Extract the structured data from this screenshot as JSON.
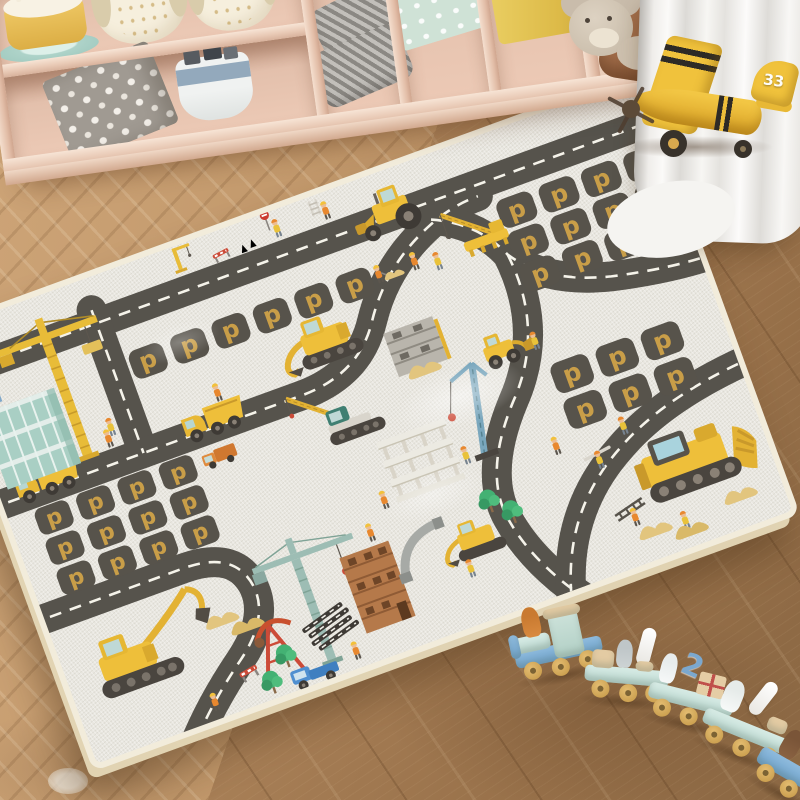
{
  "scene": {
    "name": "kids-playroom-with-construction-play-mat"
  },
  "colors": {
    "mat_background": "#e9e7e0",
    "mat_edge": "#f2ecdb",
    "road": "#56534c",
    "road_dash": "#f5f3ea",
    "parking_square": "#57534b",
    "parking_letter": "#c99e48",
    "machine_yellow": "#eebf3a",
    "shelf_wood": "#eed3c2",
    "floor_wood": "#b98f62",
    "curtain_white": "#f3f2ef",
    "train_mint": "#cfe6df",
    "train_blue": "#7fb0d6",
    "train_wheel": "#d9ae5c",
    "plane_yellow": "#f0c23c",
    "crane_teal": "#9dbdb4",
    "crane_blue": "#7aa7bd",
    "brick_brown": "#b5794a",
    "tree_green": "#43b173",
    "sand_tan": "#e2c57e"
  },
  "shelf": {
    "items": [
      "birthday-cake-toy",
      "owl-plush-large",
      "owl-plush-small",
      "polka-dot-storage-box",
      "toy-basket-with-blocks",
      "chevron-cushions",
      "pink-storage-bin",
      "white-storage-box",
      "mint-polka-bin",
      "yellow-storage-bin",
      "teddy-bear",
      "brown-cushion"
    ]
  },
  "plane": {
    "name": "yellow-toy-airplane",
    "tail_number": "33"
  },
  "mat": {
    "name": "construction-road-play-mat",
    "parking_letter": "p",
    "features": [
      "roads-with-dashed-lines",
      "parking-spots",
      "backhoe-loader",
      "mobile-crane",
      "excavator",
      "dump-trucks",
      "yellow-tower-crane",
      "glass-building",
      "crawler-crane",
      "scaffold-building",
      "wheel-loader",
      "blue-tower-crane",
      "building-frame",
      "bulldozer",
      "large-excavator",
      "teal-tower-crane",
      "brick-building",
      "mini-excavator",
      "oil-derrick",
      "blue-pickup-truck",
      "trees",
      "sand-piles",
      "construction-workers",
      "traffic-cones",
      "stop-sign",
      "ladders",
      "barriers"
    ]
  },
  "train": {
    "name": "wooden-animal-train",
    "car_number": "2",
    "cars": [
      "engine-with-fox",
      "car-with-mouse-and-candle",
      "car-with-cat-number-and-gift",
      "car-with-bear-and-candle",
      "car-with-dog"
    ]
  }
}
